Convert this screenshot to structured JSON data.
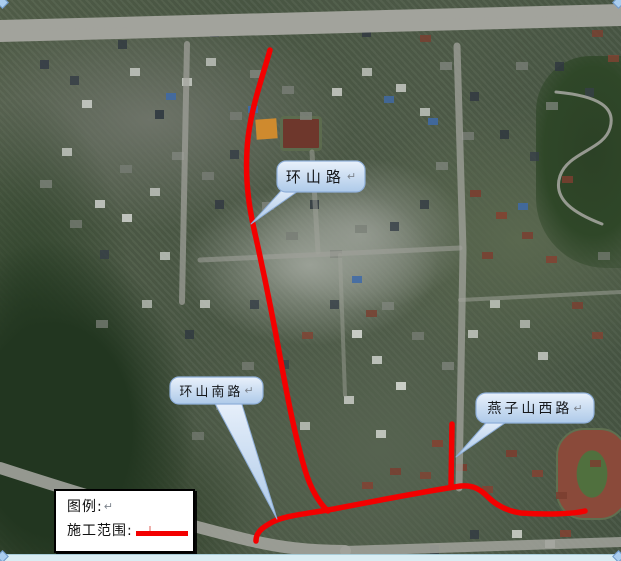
{
  "figure": {
    "kind": "satellite-map-annotation"
  },
  "callouts": [
    {
      "name": "huanshan-road",
      "label": "环山路",
      "return_mark": "↵"
    },
    {
      "name": "huanshan-south-road",
      "label": "环山南路",
      "return_mark": "↵"
    },
    {
      "name": "yanzishan-west-road",
      "label": "燕子山西路",
      "return_mark": "↵"
    }
  ],
  "legend": {
    "title": "图例:",
    "title_return_mark": "↵",
    "item_label": "施工范围:"
  },
  "colors": {
    "construction_line": "#f30000",
    "callout_fill_top": "#e9f1fb",
    "callout_fill_bottom": "#aecae9",
    "callout_border": "#8fafd9",
    "legend_bg": "#ffffff",
    "legend_border": "#000000"
  }
}
